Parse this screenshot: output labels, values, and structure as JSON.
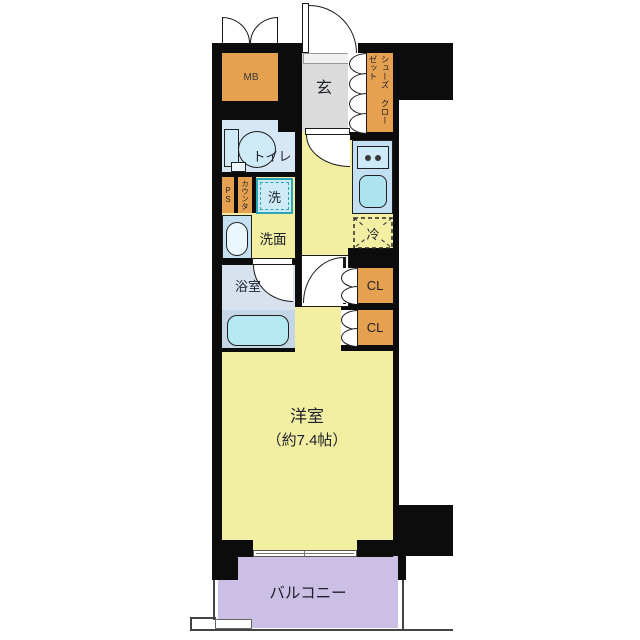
{
  "rooms": {
    "mb": "MB",
    "genkan": "玄",
    "shoe_closet_col1": "シューズ",
    "shoe_closet_col2": "クローゼット",
    "toilet": "トイレ",
    "pipe_space": "PS",
    "counter": "カウンタ",
    "washer": "洗",
    "washroom": "洗面",
    "fridge": "冷",
    "bathroom": "浴室",
    "closet_upper": "CL",
    "closet_lower": "CL",
    "main_room": "洋室",
    "main_room_size": "（約7.4帖）",
    "balcony": "バルコニー"
  },
  "colors": {
    "wall": "#0c0c0c",
    "floor": "#f2efa2",
    "genkan": "#dbdbdb",
    "room_blue": "#d6e7f6",
    "counter_blue": "#c3e0f2",
    "fixture_blue": "#cdeaf6",
    "sink_cyan": "#ace3ee",
    "tub_cyan": "#b5e9f2",
    "bath_floor": "#d7e2ee",
    "tub_zone": "#c5d6e6",
    "orange": "#e5a150",
    "purple": "#cbbfe5",
    "teal": "#2ba7b8",
    "text": "#1d212b"
  }
}
